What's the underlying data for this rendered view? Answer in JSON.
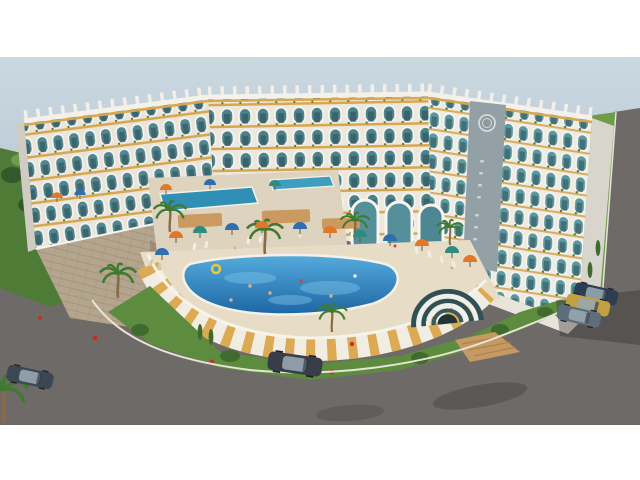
{
  "meta": {
    "type": "architectural-3d-rendering",
    "subject": "curved seaside resort apartment complex with courtyard pool, aerial three-quarter view",
    "letterboxed": "white bars top and bottom"
  },
  "palette": {
    "letterbox": "#ffffff",
    "sky_top": "#cbd8e0",
    "sky_bottom": "#b1c5d1",
    "facade": "#eae5db",
    "glass_teal": "#4f868f",
    "accent_gold": "#d8a64f",
    "stone": "#b3a58e",
    "deck": "#e7ddc6",
    "pool_light": "#55abdd",
    "pool_dark": "#1d66a4",
    "wall_white": "#f1ede3",
    "wall_gold": "#dcaa52",
    "grass": "#5d8c3e",
    "hill_green": "#4e7b36",
    "right_grass": "#6f9c4a",
    "tree_dark": "#3c5a31",
    "road": "#6e6a67",
    "curb": "#e8e3d7",
    "umbrella_orange": "#e0782a",
    "umbrella_blue": "#2f6fae",
    "umbrella_teal": "#2e8b80",
    "pavilion_dark": "#2f5156",
    "pavilion_light": "#eef0ec",
    "wood": "#c49a62"
  },
  "scene": {
    "building": {
      "form": "long arc-shaped block of three wings",
      "floors": 7,
      "style": "repeating arched balcony frames, teal glass railings, gold floor bands, white roof fins, balcony planters",
      "emblem": "circular clock-like medallion on grey panel of right wing",
      "signage": "illegible small vertical lettering below emblem",
      "base": "stone-clad podium with white staircase on the left"
    },
    "amenities": {
      "main_pool": "large freeform blue pool with swimmers and a yellow float ring",
      "pool_wall": "curved retaining wall of alternating white and gold panels",
      "upper_terrace": "raised deck with second small pool, pergolas and umbrellas",
      "entrance_pavilion": "striped ribbed arch tunnel with wooden walkway",
      "umbrella_colors": [
        "orange",
        "blue",
        "teal"
      ],
      "sun_loungers": true
    },
    "landscape": {
      "palm_trees": 7,
      "lawns_with_red_flower_bushes": true,
      "hillside_shrubs_left": true,
      "tree_row_along_right_road": true
    },
    "vehicles": {
      "driving": [
        {
          "type": "sedan",
          "color": "#3c4754",
          "position": "bottom-left road"
        },
        {
          "type": "suv",
          "color": "#373e48",
          "position": "bottom-center road"
        }
      ],
      "parked_beside_building": [
        {
          "color": "#2e3e52"
        },
        {
          "color": "#c2a041"
        },
        {
          "color": "#5e6d7a"
        }
      ]
    },
    "roads": "wide grey asphalt curving around the site with white curbs and tree shadows"
  }
}
